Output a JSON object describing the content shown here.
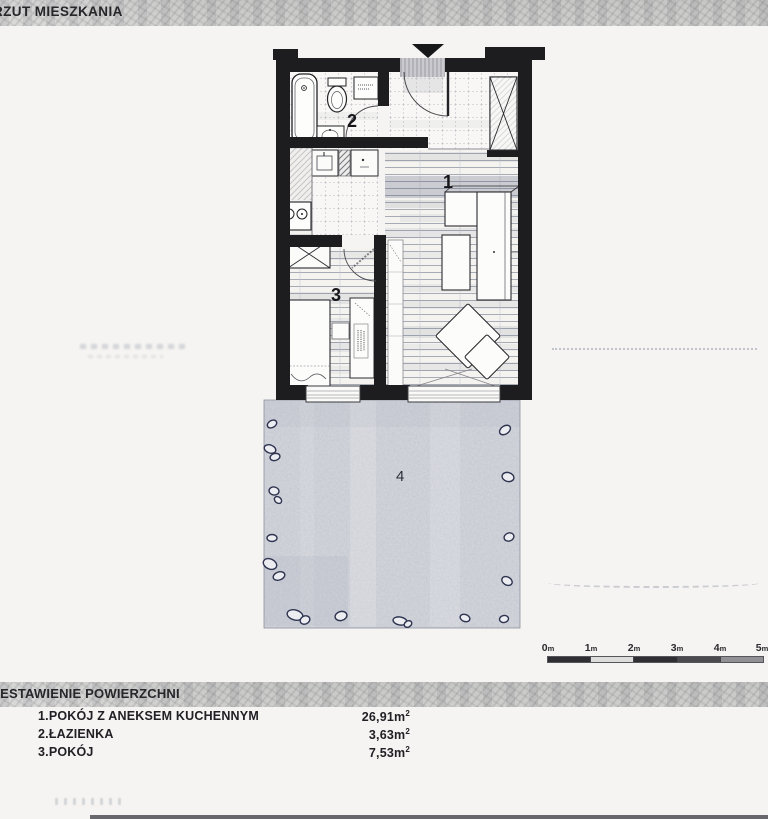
{
  "page": {
    "title": "RZUT MIESZKANIA"
  },
  "plan": {
    "labels": {
      "room1": "1",
      "room2": "2",
      "room3": "3",
      "garden": "4"
    }
  },
  "scalebar": {
    "ticks": [
      {
        "n": "0",
        "u": "m"
      },
      {
        "n": "1",
        "u": "m"
      },
      {
        "n": "2",
        "u": "m"
      },
      {
        "n": "3",
        "u": "m"
      },
      {
        "n": "4",
        "u": "m"
      },
      {
        "n": "5",
        "u": "m"
      }
    ]
  },
  "legend": {
    "header": "ZESTAWIENIE POWIERZCHNI",
    "rows": [
      {
        "name": "1.POKÓJ Z ANEKSEM KUCHENNYM",
        "value": "26,91",
        "unit": "m",
        "sup": "2"
      },
      {
        "name": "2.ŁAZIENKA",
        "value": "3,63",
        "unit": "m",
        "sup": "2"
      },
      {
        "name": "3.POKÓJ",
        "value": "7,53",
        "unit": "m",
        "sup": "2"
      }
    ]
  },
  "colors": {
    "wall": "#1d1d20",
    "garden": "#d6d8dd",
    "band": "#c9c9c7",
    "paper": "#f5f4f2"
  }
}
